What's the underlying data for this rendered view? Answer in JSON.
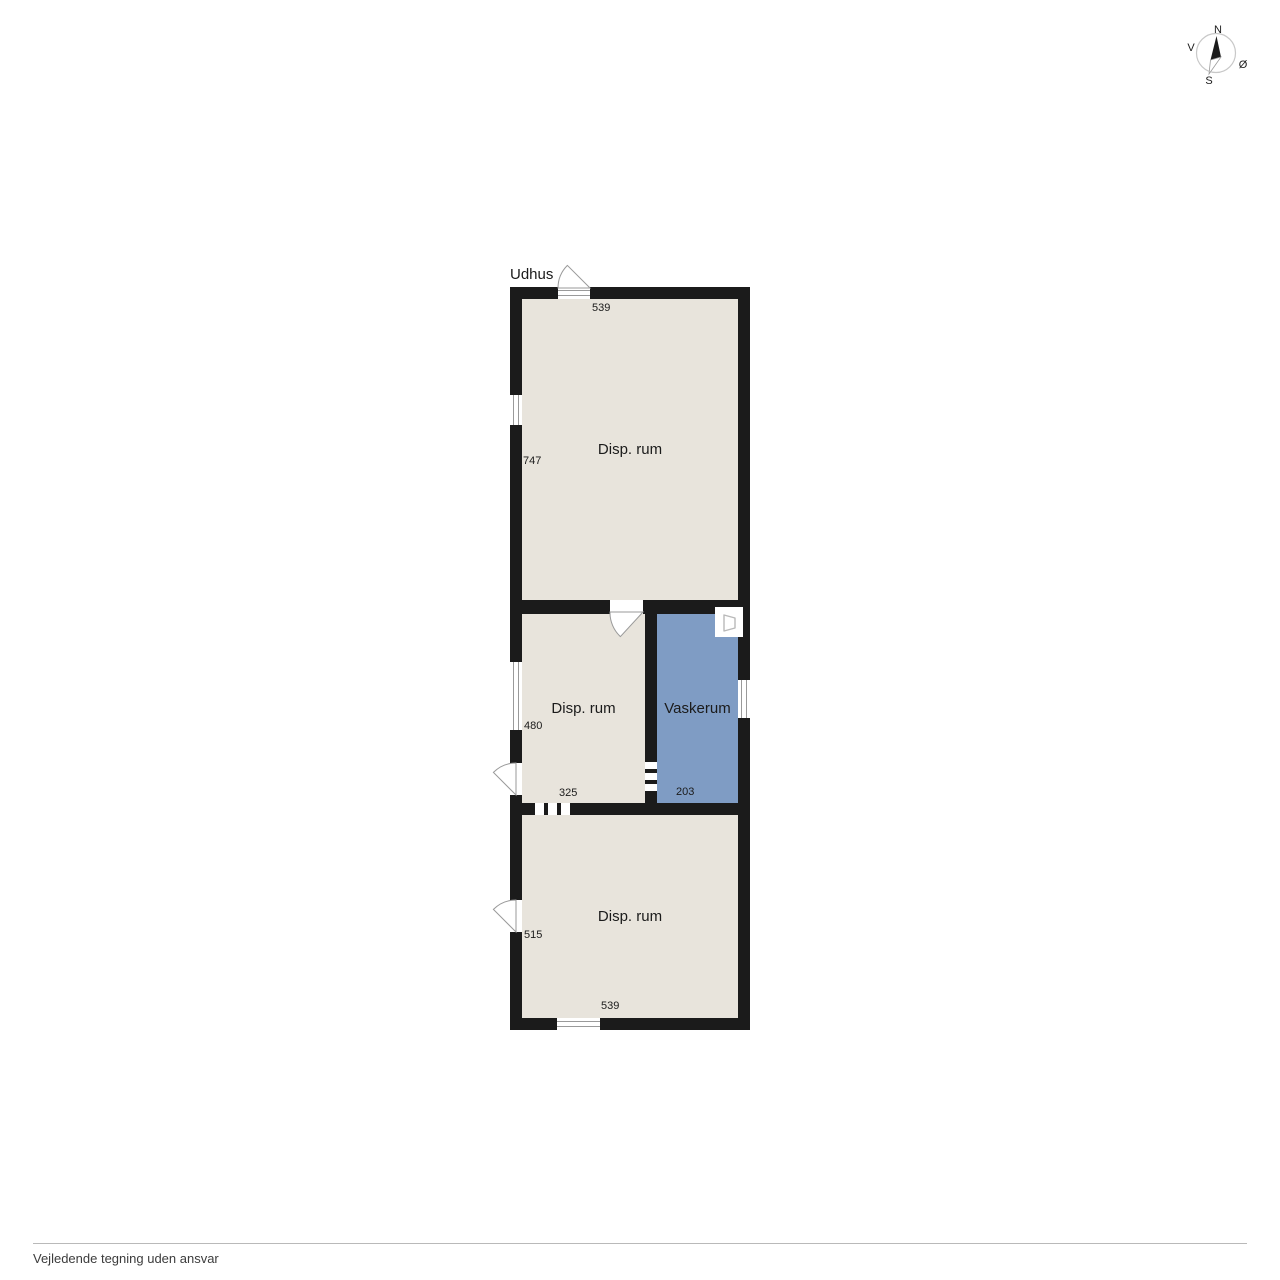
{
  "floor_plan": {
    "label": "Udhus",
    "rooms": [
      {
        "name": "Disp. rum",
        "width_cm": "539",
        "height_cm": "747"
      },
      {
        "name": "Disp. rum",
        "width_cm": "325",
        "height_cm": "480"
      },
      {
        "name": "Vaskerum",
        "width_cm": "203"
      },
      {
        "name": "Disp. rum",
        "width_cm": "539",
        "height_cm": "515"
      }
    ],
    "appliance_icon": "washing-machine"
  },
  "compass": {
    "north": "N",
    "east": "Ø",
    "south": "S",
    "west": "V"
  },
  "footer": {
    "disclaimer": "Vejledende tegning uden ansvar"
  },
  "colors": {
    "wall": "#1b1b1b",
    "room_fill": "#e8e4dc",
    "wet_room_fill": "#7f9cc4",
    "background": "#ffffff"
  }
}
